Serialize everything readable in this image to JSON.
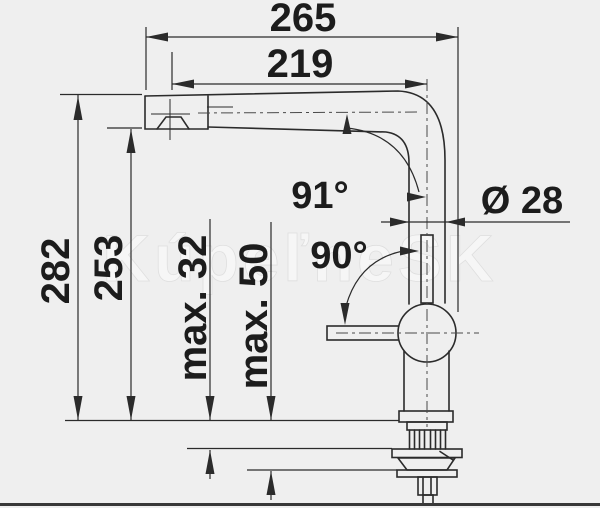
{
  "diagram": {
    "dimensions": {
      "total_reach": "265",
      "spout_reach": "219",
      "total_height": "282",
      "spout_height": "253",
      "deck_thickness_small": "max. 32",
      "deck_thickness_large": "max. 50",
      "pipe_diameter": "Ø 28"
    },
    "angles": {
      "spout_angle": "91°",
      "lever_swing_angle": "90°"
    },
    "watermark": "KúpeľneSK",
    "colors": {
      "background": "#efefef",
      "line": "#2b2b2b",
      "text": "#1c1c1c",
      "watermark": "#fdfdfd"
    }
  }
}
